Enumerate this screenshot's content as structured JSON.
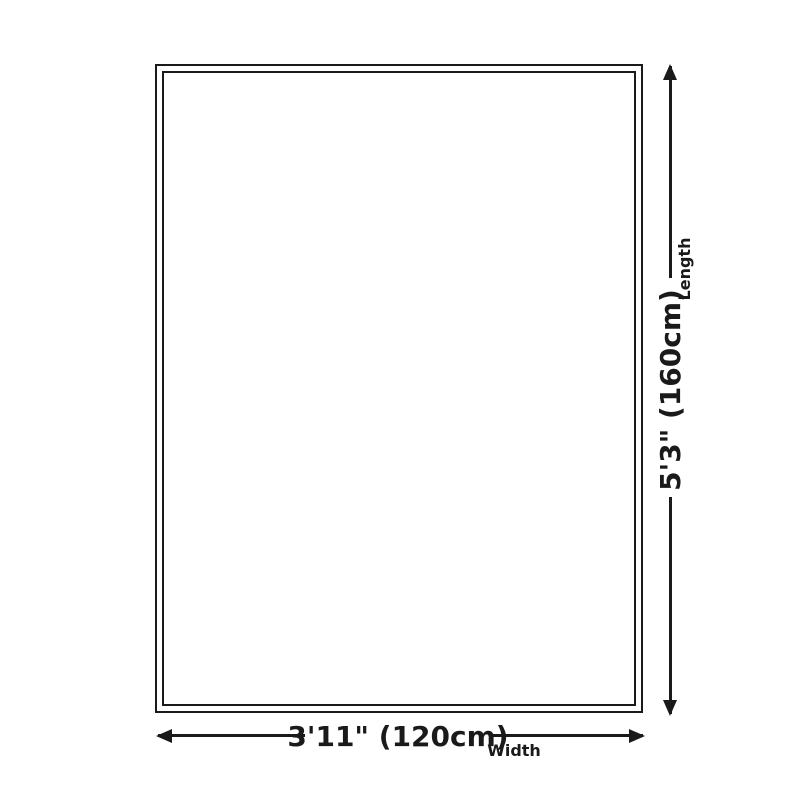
{
  "diagram": {
    "length": {
      "value": "5'3\" (160cm)",
      "label": "Length"
    },
    "width": {
      "value": "3'11\" (120cm)",
      "label": "Width"
    }
  },
  "colors": {
    "line": "#1a1a1a",
    "background": "#ffffff"
  }
}
